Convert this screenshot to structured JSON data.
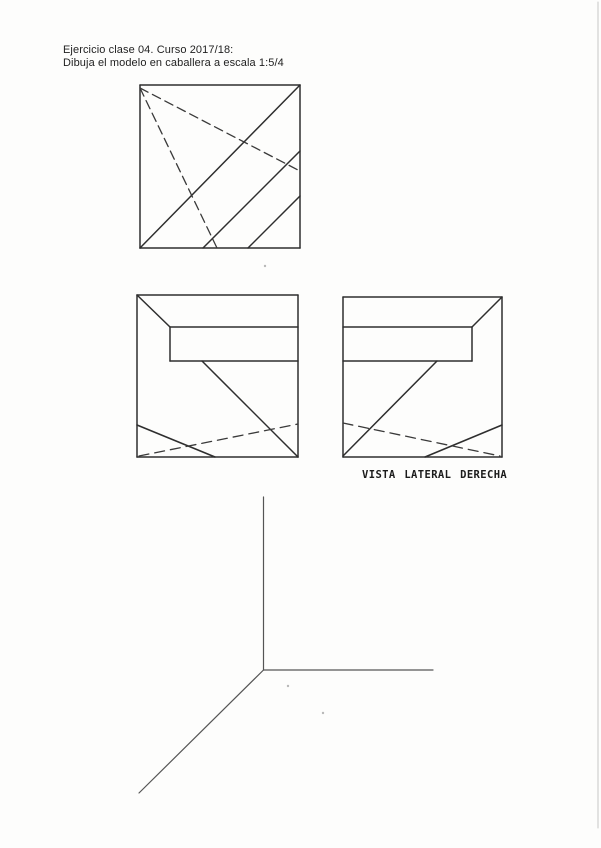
{
  "header": {
    "line1": "Ejercicio clase 04. Curso 2017/18:",
    "line2": "Dibuja el modelo en caballera a escala 1:5/4"
  },
  "labels": {
    "side_view": "VISTA LATERAL DERECHA"
  },
  "colors": {
    "paper": "#fdfdfc",
    "ink": "#2e2e2e",
    "hidden_line": "#3a3a3a",
    "axis": "#555555",
    "scan_artifact": "#c6c6c6"
  },
  "drawing": {
    "canvas": {
      "width": 601,
      "height": 848
    },
    "groups": [
      {
        "name": "plan-view-visible-edges",
        "color": "#2e2e2e",
        "width": 1.5,
        "dash": "",
        "lines": [
          [
            140,
            85,
            300,
            85
          ],
          [
            300,
            85,
            300,
            248
          ],
          [
            300,
            248,
            140,
            248
          ],
          [
            140,
            248,
            140,
            85
          ],
          [
            140,
            248,
            300,
            85
          ],
          [
            203,
            248,
            300,
            151
          ],
          [
            248,
            248,
            300,
            196
          ]
        ]
      },
      {
        "name": "plan-view-hidden-edges",
        "color": "#3a3a3a",
        "width": 1.3,
        "dash": "9 5",
        "lines": [
          [
            140,
            88,
            217,
            248
          ],
          [
            140,
            88,
            298,
            170
          ]
        ]
      },
      {
        "name": "front-view-visible-edges",
        "color": "#2e2e2e",
        "width": 1.5,
        "dash": "",
        "lines": [
          [
            137,
            295,
            298,
            295
          ],
          [
            298,
            295,
            298,
            457
          ],
          [
            298,
            457,
            137,
            457
          ],
          [
            137,
            457,
            137,
            295
          ],
          [
            137,
            295,
            170,
            327
          ],
          [
            170,
            327,
            298,
            327
          ],
          [
            170,
            361,
            298,
            361
          ],
          [
            170,
            327,
            170,
            361
          ],
          [
            202,
            361,
            298,
            457
          ],
          [
            137,
            425,
            215,
            457
          ]
        ]
      },
      {
        "name": "front-view-hidden-edges",
        "color": "#3a3a3a",
        "width": 1.3,
        "dash": "10 6",
        "lines": [
          [
            139,
            456,
            298,
            424
          ]
        ]
      },
      {
        "name": "side-view-visible-edges",
        "color": "#2e2e2e",
        "width": 1.5,
        "dash": "",
        "lines": [
          [
            343,
            297,
            502,
            297
          ],
          [
            502,
            297,
            502,
            457
          ],
          [
            502,
            457,
            343,
            457
          ],
          [
            343,
            457,
            343,
            297
          ],
          [
            502,
            297,
            472,
            327
          ],
          [
            343,
            327,
            472,
            327
          ],
          [
            343,
            361,
            472,
            361
          ],
          [
            472,
            327,
            472,
            361
          ],
          [
            437,
            361,
            343,
            456
          ],
          [
            425,
            457,
            502,
            425
          ]
        ]
      },
      {
        "name": "side-view-hidden-edges",
        "color": "#3a3a3a",
        "width": 1.3,
        "dash": "10 6",
        "lines": [
          [
            343,
            423,
            500,
            456
          ]
        ]
      },
      {
        "name": "caballera-axes",
        "color": "#555555",
        "width": 1.2,
        "dash": "",
        "lines": [
          [
            263.5,
            497,
            263.5,
            670
          ],
          [
            263.5,
            670,
            433,
            670
          ],
          [
            263.5,
            670,
            139,
            793
          ]
        ]
      },
      {
        "name": "scan-edge-artifact",
        "color": "#c6c6c6",
        "width": 1,
        "dash": "",
        "lines": [
          [
            598,
            2,
            598,
            828
          ]
        ]
      }
    ],
    "specks": [
      [
        265,
        266
      ],
      [
        288,
        686
      ],
      [
        323,
        713
      ]
    ]
  }
}
